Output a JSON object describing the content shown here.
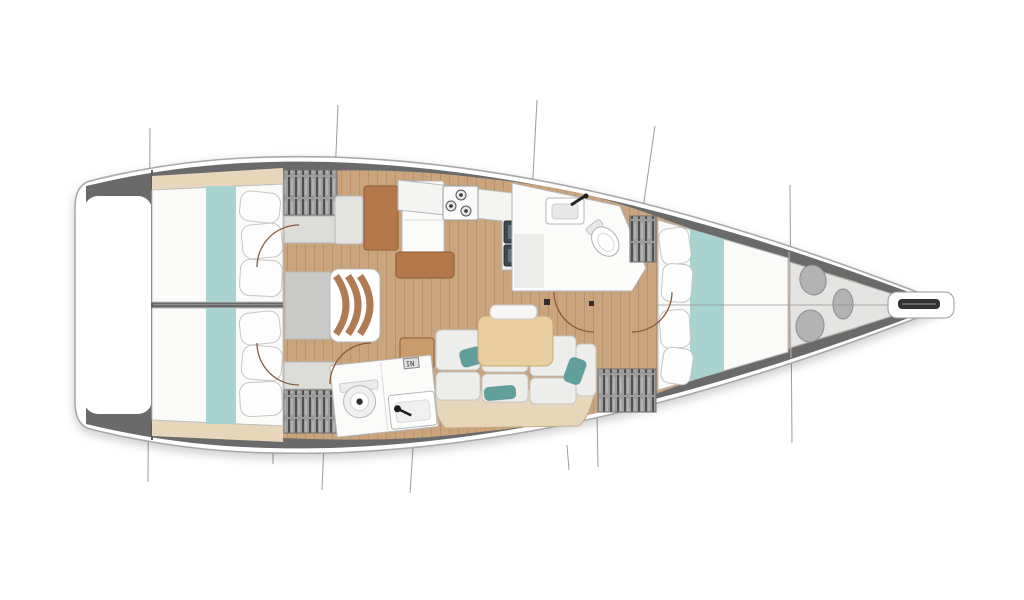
{
  "diagram": {
    "type": "yacht-interior-floor-plan",
    "orientation": "bow-right",
    "vent_badge": "IN",
    "colors": {
      "hull_fill": "#ffffff",
      "deck_band": "#6a6a6a",
      "floor_wood": "#c9a47d",
      "shelf_tan": "#e7d6ba",
      "bed_white": "#fafaf9",
      "bed_runner_teal": "#a9d3d1",
      "pillow_teal": "#619e9c",
      "cushion_white": "#ededeb",
      "table_wood": "#e9cfa0",
      "furniture_brown": "#b5784a",
      "end_table_tan": "#c99c6d",
      "counter_white": "#f4f4f2",
      "landing_gray": "#c9c9c7",
      "steps_wood": "#b07a52",
      "locker_gray": "#e4e4e2",
      "bag_gray": "#b3b3b3",
      "sink_dark": "#41474c",
      "door_arc": "#8a5c3c",
      "section_line": "#9b9b9b",
      "centerline": "#8f8f8f"
    },
    "areas": [
      {
        "id": "cockpit",
        "label": "cockpit"
      },
      {
        "id": "aft-cabin-port",
        "label": "aft cabin (port)"
      },
      {
        "id": "aft-cabin-starboard",
        "label": "aft cabin (starboard)"
      },
      {
        "id": "companionway",
        "label": "companionway steps"
      },
      {
        "id": "nav-station",
        "label": "nav station"
      },
      {
        "id": "galley",
        "label": "galley"
      },
      {
        "id": "salon",
        "label": "salon settee and table"
      },
      {
        "id": "head-aft",
        "label": "aft head"
      },
      {
        "id": "head-forward",
        "label": "forward head"
      },
      {
        "id": "cabin-forward",
        "label": "forward cabin"
      },
      {
        "id": "sail-locker",
        "label": "bow sail locker"
      },
      {
        "id": "bowsprit",
        "label": "bowsprit / anchor roller"
      }
    ]
  }
}
